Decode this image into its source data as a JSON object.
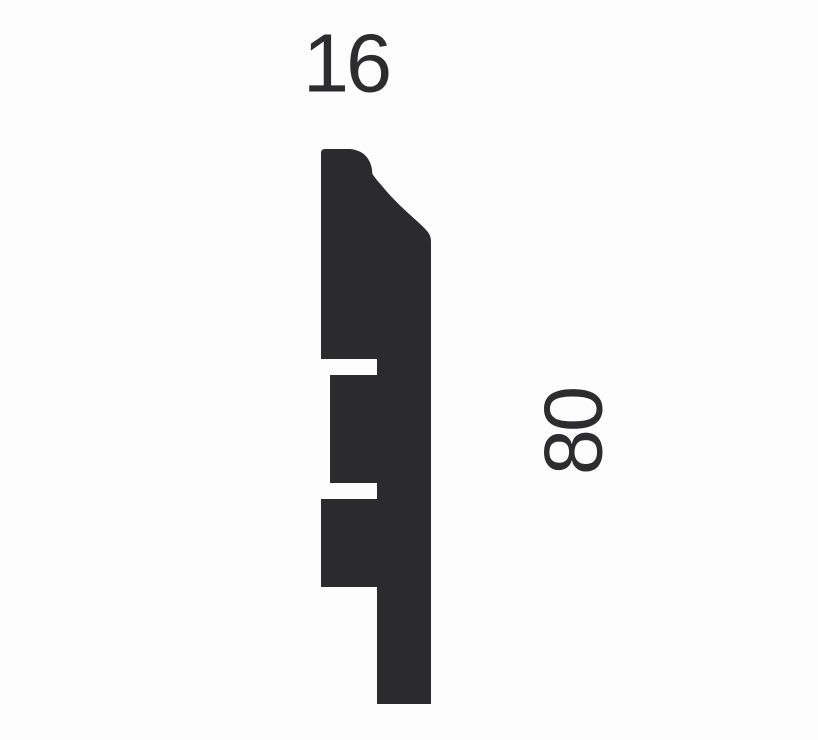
{
  "diagram": {
    "type": "moulding-profile-cross-section",
    "description": "Cross-section silhouette of a skirting board profile with two dimension labels",
    "labels": {
      "width": "16",
      "height": "80"
    },
    "colors": {
      "profile_fill": "#2b2b2d",
      "background": "#fdfdfd",
      "label_text": "#2d2d2f"
    }
  }
}
